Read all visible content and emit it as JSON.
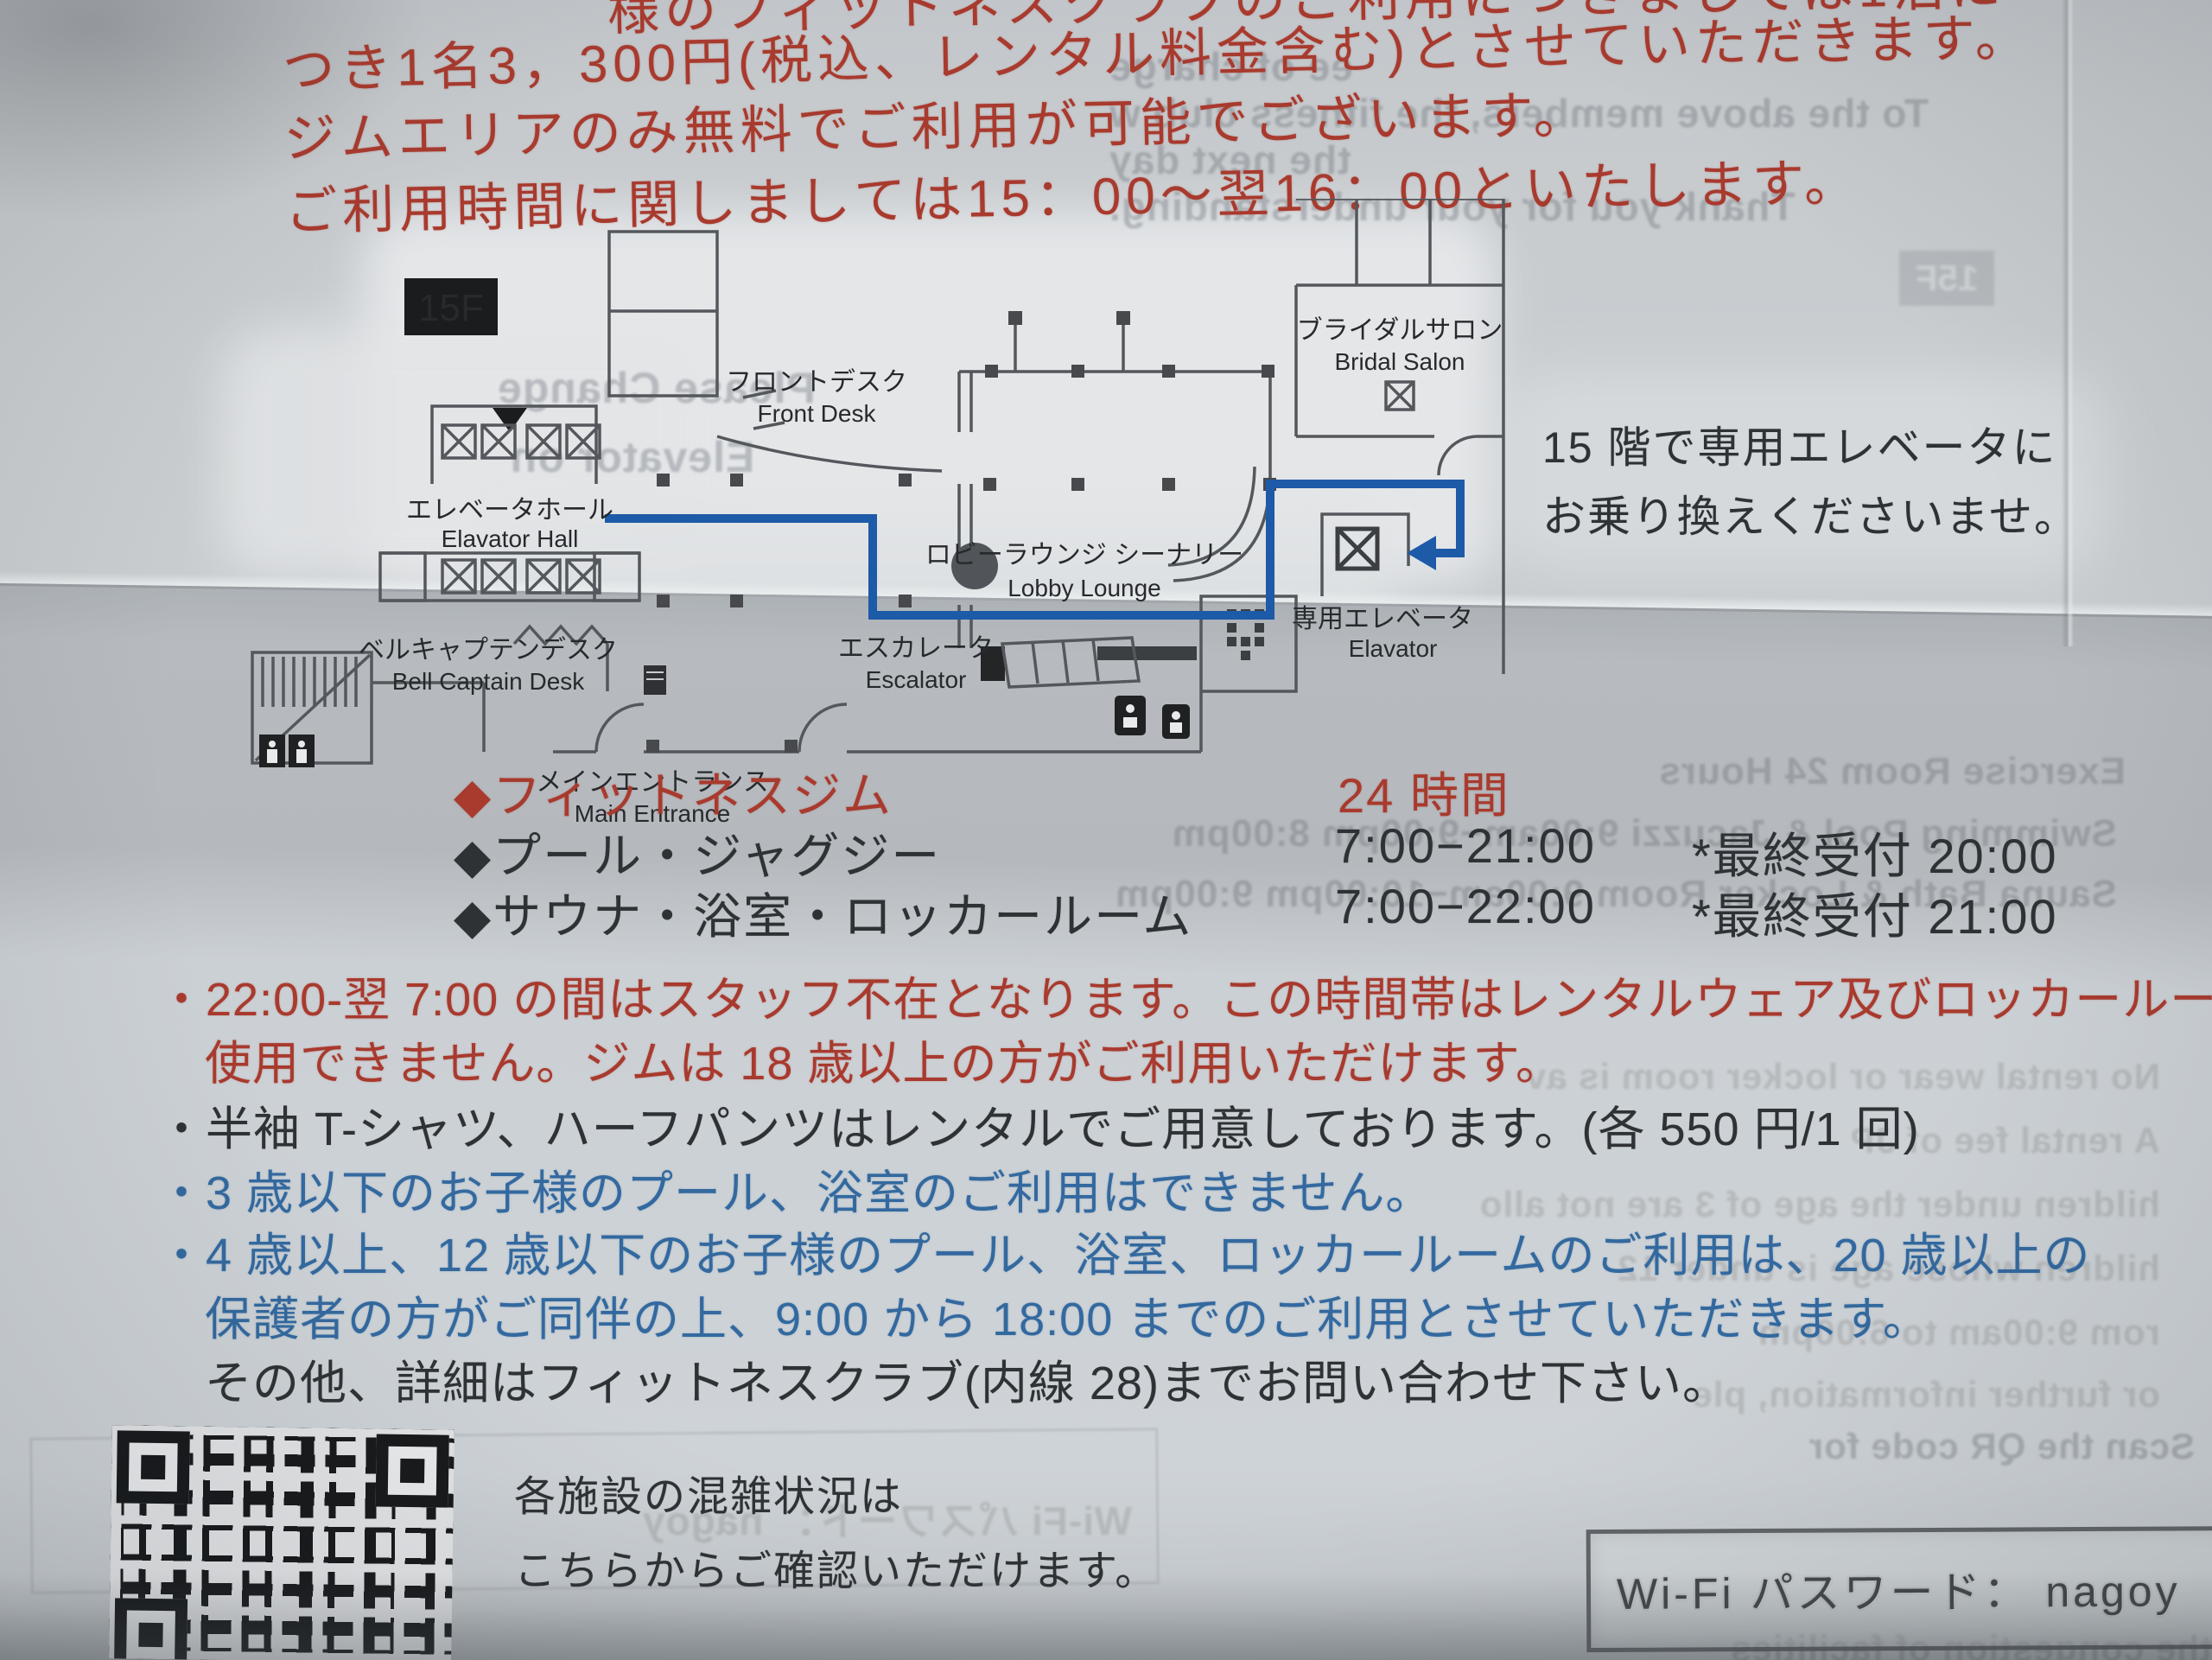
{
  "document": {
    "header": {
      "clipped_line": "様のフィットネスクラブのご利用につきましては1泊に",
      "line1": "つき1名3，300円(税込、レンタル料金含む)とさせていただきます。",
      "line2": "ジムエリアのみ無料でご利用が可能でございます。",
      "line3": "ご利用時間に関しましては15：00～翌16：00といたします。"
    },
    "map": {
      "floor_badge": "15F",
      "labels": {
        "elevator_hall": {
          "jp": "エレベータホール",
          "en": "Elavator Hall"
        },
        "front_desk": {
          "jp": "フロントデスク",
          "en": "Front Desk"
        },
        "bell_captain": {
          "jp": "ベルキャプテンデスク",
          "en": "Bell Captain Desk"
        },
        "main_entrance": {
          "jp": "メインエントランス",
          "en": "Main Entrance"
        },
        "escalator": {
          "jp": "エスカレータ",
          "en": "Escalator"
        },
        "lobby_lounge": {
          "jp": "ロビーラウンジ シーナリー",
          "en": "Lobby Lounge"
        },
        "bridal_salon": {
          "jp": "ブライダルサロン",
          "en": "Bridal Salon"
        },
        "private_elevator": {
          "jp": "専用エレベータ",
          "en": "Elavator"
        }
      },
      "side_note1": "15 階で専用エレベータに",
      "side_note2": "お乗り換えくださいませ。"
    },
    "hours": {
      "bullet": "◆",
      "rows": [
        {
          "name": "フィットネスジム",
          "hours": "24 時間",
          "last_entry": ""
        },
        {
          "name": "プール・ジャグジー",
          "hours": "7:00−21:00",
          "last_entry": "*最終受付 20:00"
        },
        {
          "name": "サウナ・浴室・ロッカールーム",
          "hours": "7:00−22:00",
          "last_entry": "*最終受付 21:00"
        }
      ]
    },
    "notes": [
      {
        "text": "・22:00-翌 7:00 の間はスタッフ不在となります。この時間帯はレンタルウェア及びロッカールームは"
      },
      {
        "text": "使用できません。ジムは 18 歳以上の方がご利用いただけます。"
      },
      {
        "text": "・半袖 T-シャツ、ハーフパンツはレンタルでご用意しております。(各 550 円/1 回)"
      },
      {
        "text": "・3 歳以下のお子様のプール、浴室のご利用はできません。"
      },
      {
        "text": "・4 歳以上、12 歳以下のお子様のプール、浴室、ロッカールームのご利用は、20 歳以上の"
      },
      {
        "text": "保護者の方がご同伴の上、9:00 から 18:00 までのご利用とさせていただきます。"
      },
      {
        "text": "その他、詳細はフィットネスクラブ(内線 28)までお問い合わせ下さい。"
      }
    ],
    "qr": {
      "caption1": "各施設の混雑状況は",
      "caption2": "こちらからご確認いただけます。"
    },
    "wifi": {
      "label": "Wi-Fi パスワード： nagoy"
    },
    "showthrough": [
      {
        "text": "ee of charge"
      },
      {
        "text": "To the above members, the fitness club w"
      },
      {
        "text": "the next day"
      },
      {
        "text": "Thank you for your understanding."
      },
      {
        "text": "15F"
      },
      {
        "text": "Please Change"
      },
      {
        "text": "Elevator on"
      },
      {
        "text": "Exercise Room   24 Hours"
      },
      {
        "text": "Swimming Pool & Jacuzzi    9:00am−9:00pm    8:00pm"
      },
      {
        "text": "Sauna Bath & Locker Room    9:00am−10:00pm    9:00pm"
      },
      {
        "text": "No rental wear or locker room is av"
      },
      {
        "text": "A rental fee of JP"
      },
      {
        "text": "hildren under the age of 3 are not allo"
      },
      {
        "text": "hildren whose age is under 12"
      },
      {
        "text": "rom 9:00am to 6:00pm"
      },
      {
        "text": "or further information, ple"
      },
      {
        "text": "Scan the QR code for"
      },
      {
        "text": "the congestion of facilities"
      },
      {
        "text": "Wi-Fi パスワード： nagoy"
      }
    ],
    "colors": {
      "accent_red": "#a83a2e",
      "text_black": "#2f3235",
      "text_blue": "#33699f",
      "route_blue": "#1d5aa8",
      "paper": "#c9cdd1"
    }
  }
}
